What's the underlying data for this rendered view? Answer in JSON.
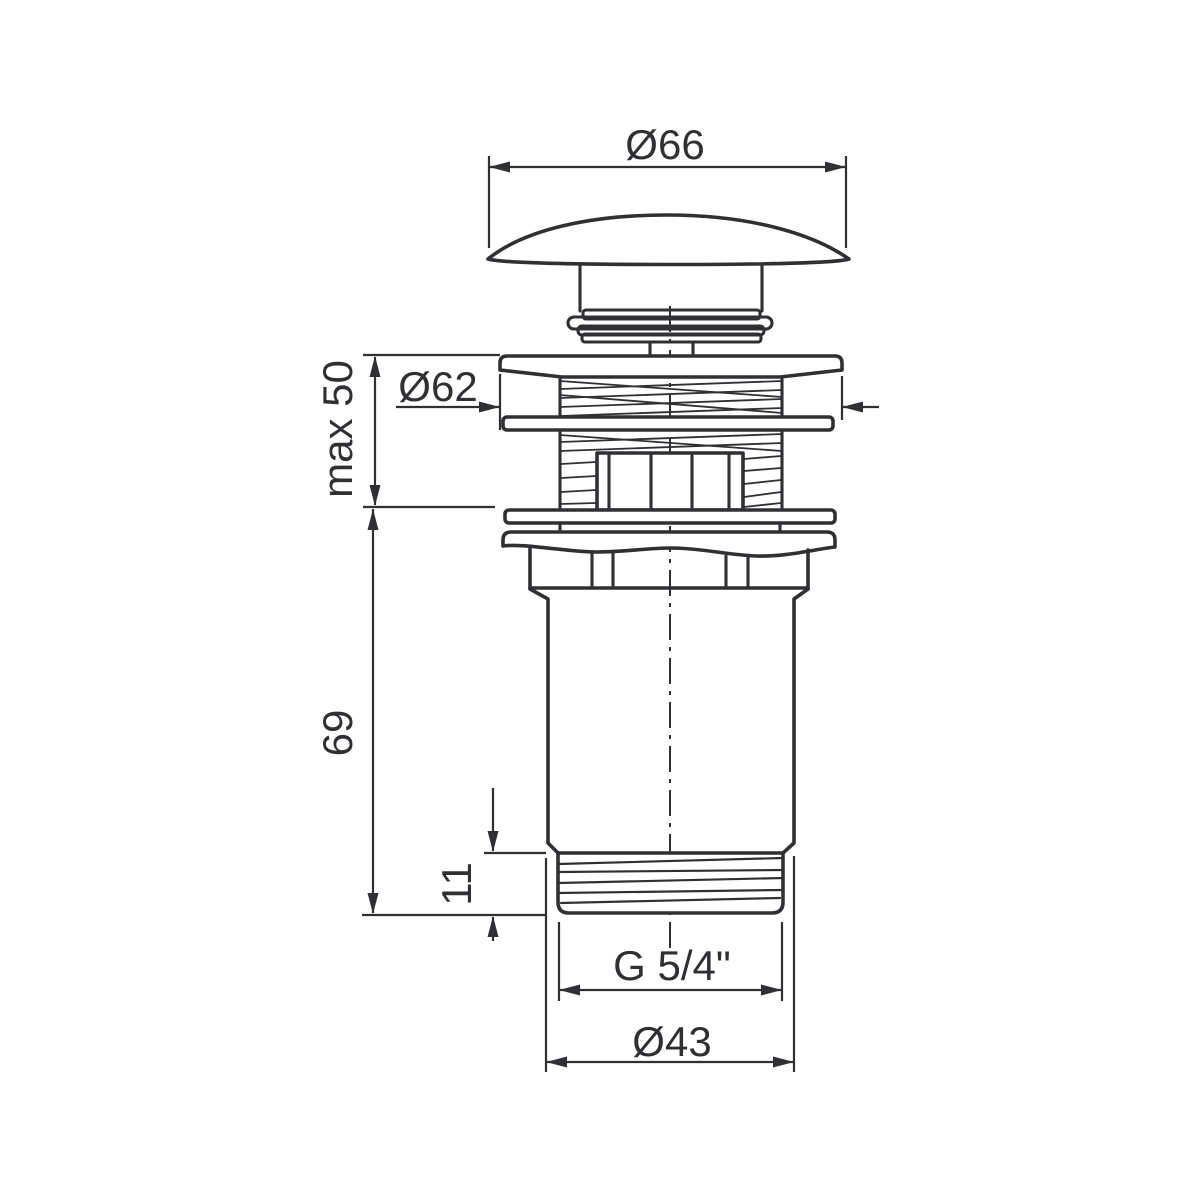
{
  "drawing": {
    "dimension_labels": {
      "cap_diameter": "Ø66",
      "flange_diameter": "Ø62",
      "clamping_range": "max 50",
      "body_length": "69",
      "thread_length": "11",
      "thread_designation": "G 5/4\"",
      "thread_outer_diameter": "Ø43"
    },
    "colors": {
      "line": "#2e3033",
      "background": "#ffffff"
    }
  }
}
